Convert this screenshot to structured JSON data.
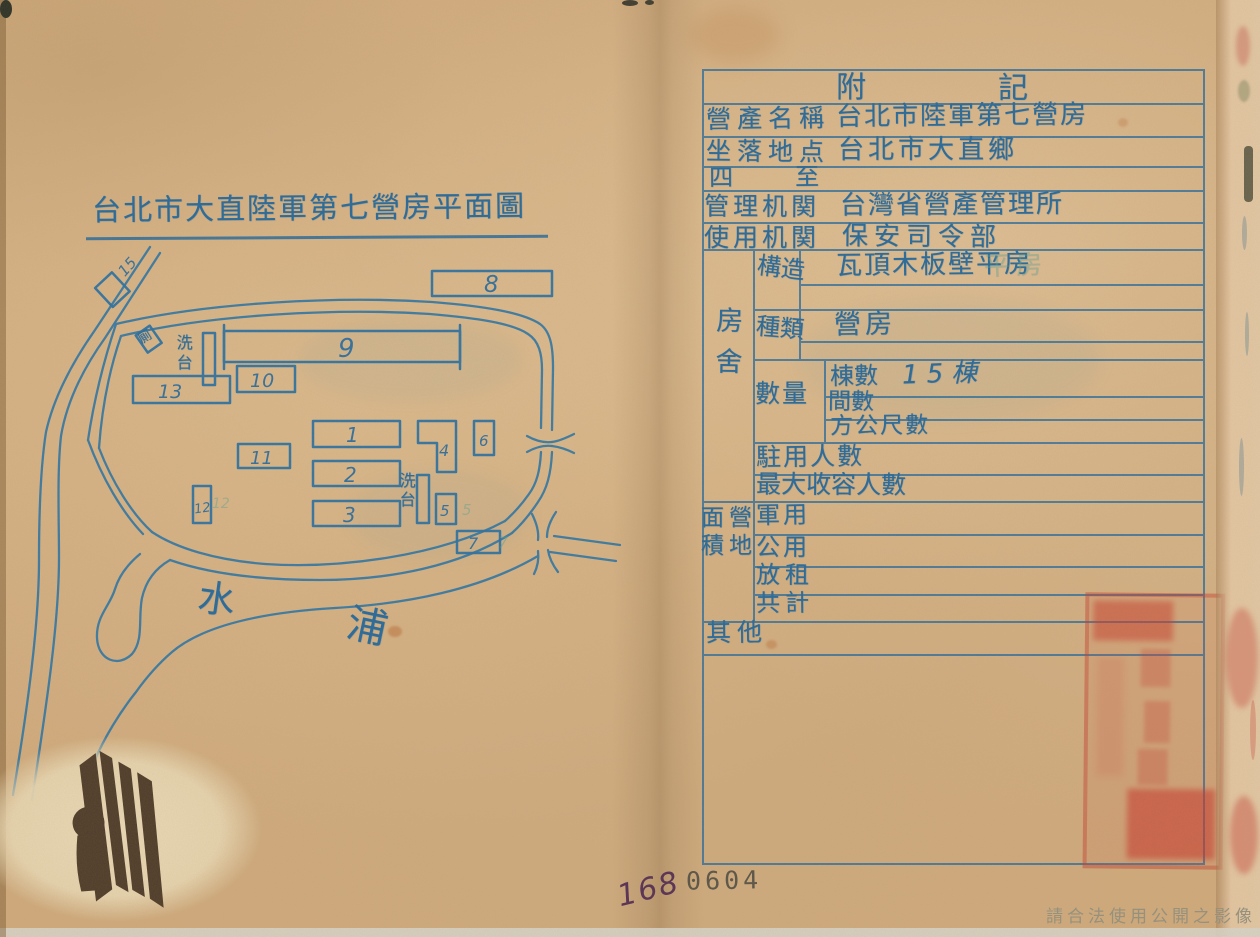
{
  "colors": {
    "ink_blue": "#2e75a4",
    "stamp_red": "#c43b2e",
    "paper": "#cfa97b"
  },
  "left_page": {
    "title": "台北市大直陸軍第七營房平面圖",
    "map": {
      "river_labels": [
        "水",
        "浦"
      ],
      "wash_stand_upper": "洗台",
      "wash_stand_lower": "洗台",
      "toilet_label": "厠",
      "building_numbers": {
        "b1": "1",
        "b2": "2",
        "b3": "3",
        "b4": "4",
        "b5": "5",
        "b6": "6",
        "b7": "7",
        "b8": "8",
        "b9": "9",
        "b10": "10",
        "b11": "11",
        "b12": "12",
        "b13": "13",
        "b15": "15"
      },
      "ghost_numbers": {
        "g5": "5",
        "g7": "7",
        "g12": "12"
      }
    }
  },
  "right_page": {
    "table": {
      "header": "附記",
      "rows": {
        "property_name": {
          "label": "營產名稱",
          "value": "台北市陸軍第七營房"
        },
        "location": {
          "label": "坐落地点",
          "value": "台北市大直鄉"
        },
        "boundaries": {
          "label": "四至",
          "value": ""
        },
        "managing_agency": {
          "label": "管理机関",
          "value": "台灣省營產管理所"
        },
        "using_agency": {
          "label": "使用机関",
          "value": "保安司令部"
        },
        "housing": {
          "label": "房舍",
          "structure": {
            "label": "構造",
            "value": "瓦頂木板壁平房",
            "ghost": "平房"
          },
          "type": {
            "label": "種類",
            "value": "營房"
          },
          "quantity": {
            "label": "數量",
            "buildings": {
              "label": "棟數",
              "value": "15棟"
            },
            "rooms": {
              "label": "間數",
              "value": ""
            },
            "square_meters": {
              "label": "方公尺數",
              "value": ""
            }
          },
          "stationed": {
            "label": "駐用人數",
            "value": ""
          },
          "max_capacity": {
            "label": "最大收容人數",
            "value": ""
          }
        },
        "camp_area": {
          "name": "營地面積",
          "label_line1": "面營",
          "label_line2": "積地",
          "military": {
            "label": "軍用",
            "value": ""
          },
          "public": {
            "label": "公用",
            "value": ""
          },
          "rented": {
            "label": "放租",
            "value": ""
          },
          "total": {
            "label": "共計",
            "value": ""
          }
        },
        "other": {
          "label": "其他",
          "value": ""
        }
      }
    }
  },
  "footer": {
    "page_number_handwritten": "168",
    "archive_number_stamp": "0604",
    "copyright_watermark": "請合法使用公開之影像"
  }
}
